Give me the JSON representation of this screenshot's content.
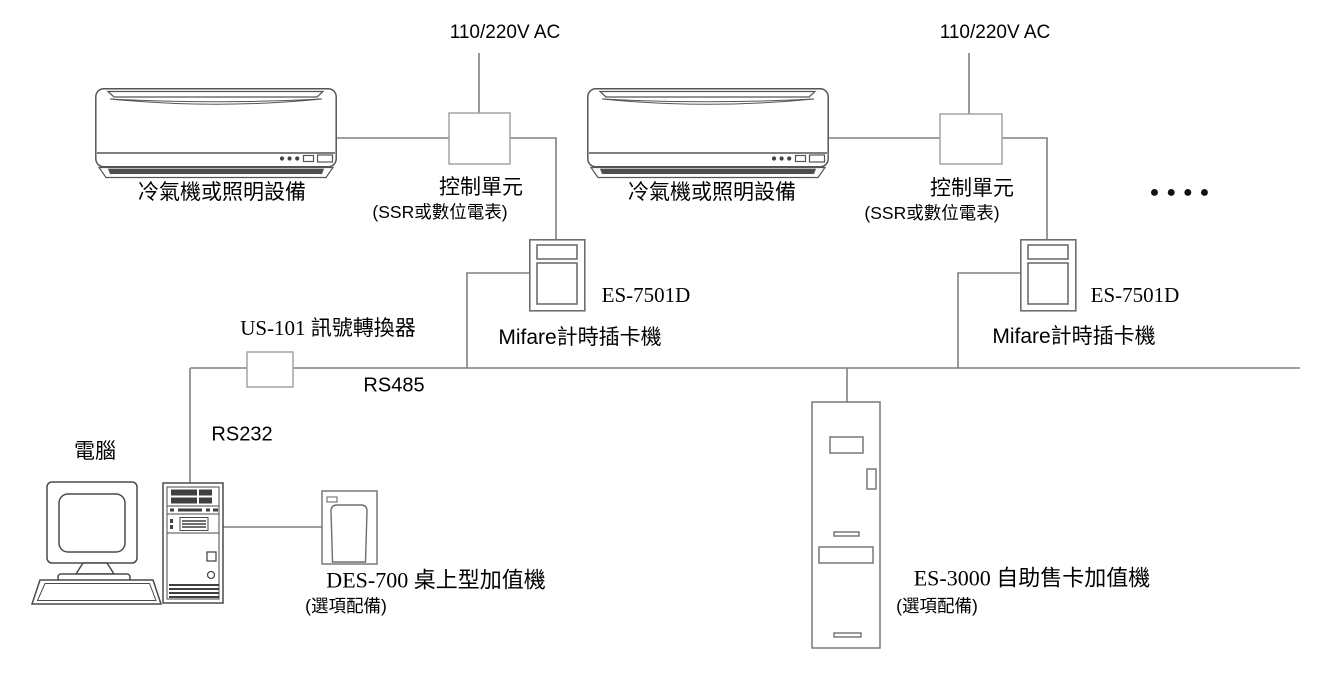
{
  "diagram_type": "system-wiring-diagram",
  "colors": {
    "background": "#ffffff",
    "connection_line": "#808080",
    "light_box_stroke": "#a3a3a3",
    "device_stroke": "#6e6e6e",
    "illustration_stroke": "#4a4a4a",
    "dark_fill": "#3f3f3f",
    "text": "#000000"
  },
  "nodes": {
    "power_supply_left": {
      "label": "110/220V AC"
    },
    "power_supply_right": {
      "label": "110/220V AC"
    },
    "ac_unit_left": {
      "label": "冷氣機或照明設備"
    },
    "ac_unit_right": {
      "label": "冷氣機或照明設備"
    },
    "control_unit_left": {
      "label": "控制單元",
      "sublabel": "(SSR或數位電表)"
    },
    "control_unit_right": {
      "label": "控制單元",
      "sublabel": "(SSR或數位電表)"
    },
    "card_reader_left": {
      "model": "ES-7501D",
      "label": "Mifare計時插卡機"
    },
    "card_reader_right": {
      "model": "ES-7501D",
      "label": "Mifare計時插卡機"
    },
    "signal_converter": {
      "label": "US-101 訊號轉換器"
    },
    "computer": {
      "label": "電腦"
    },
    "desktop_recharger": {
      "label": "DES-700 桌上型加值機",
      "sublabel": "(選項配備)"
    },
    "vending_kiosk": {
      "label": "ES-3000 自助售卡加值機",
      "sublabel": "(選項配備)"
    },
    "more_units_ellipsis": {
      "label": "●●●●"
    }
  },
  "links": {
    "rs485": {
      "label": "RS485"
    },
    "rs232": {
      "label": "RS232"
    }
  },
  "edges": [
    {
      "from": "power_supply_left",
      "to": "control_unit_left"
    },
    {
      "from": "ac_unit_left",
      "to": "control_unit_left"
    },
    {
      "from": "control_unit_left",
      "to": "card_reader_left"
    },
    {
      "from": "card_reader_left",
      "to": "rs485_bus"
    },
    {
      "from": "power_supply_right",
      "to": "control_unit_right"
    },
    {
      "from": "ac_unit_right",
      "to": "control_unit_right"
    },
    {
      "from": "control_unit_right",
      "to": "card_reader_right"
    },
    {
      "from": "card_reader_right",
      "to": "rs485_bus"
    },
    {
      "from": "signal_converter",
      "to": "rs485_bus",
      "label": "RS485"
    },
    {
      "from": "signal_converter",
      "to": "computer",
      "label": "RS232"
    },
    {
      "from": "computer",
      "to": "desktop_recharger"
    },
    {
      "from": "rs485_bus",
      "to": "vending_kiosk"
    }
  ]
}
